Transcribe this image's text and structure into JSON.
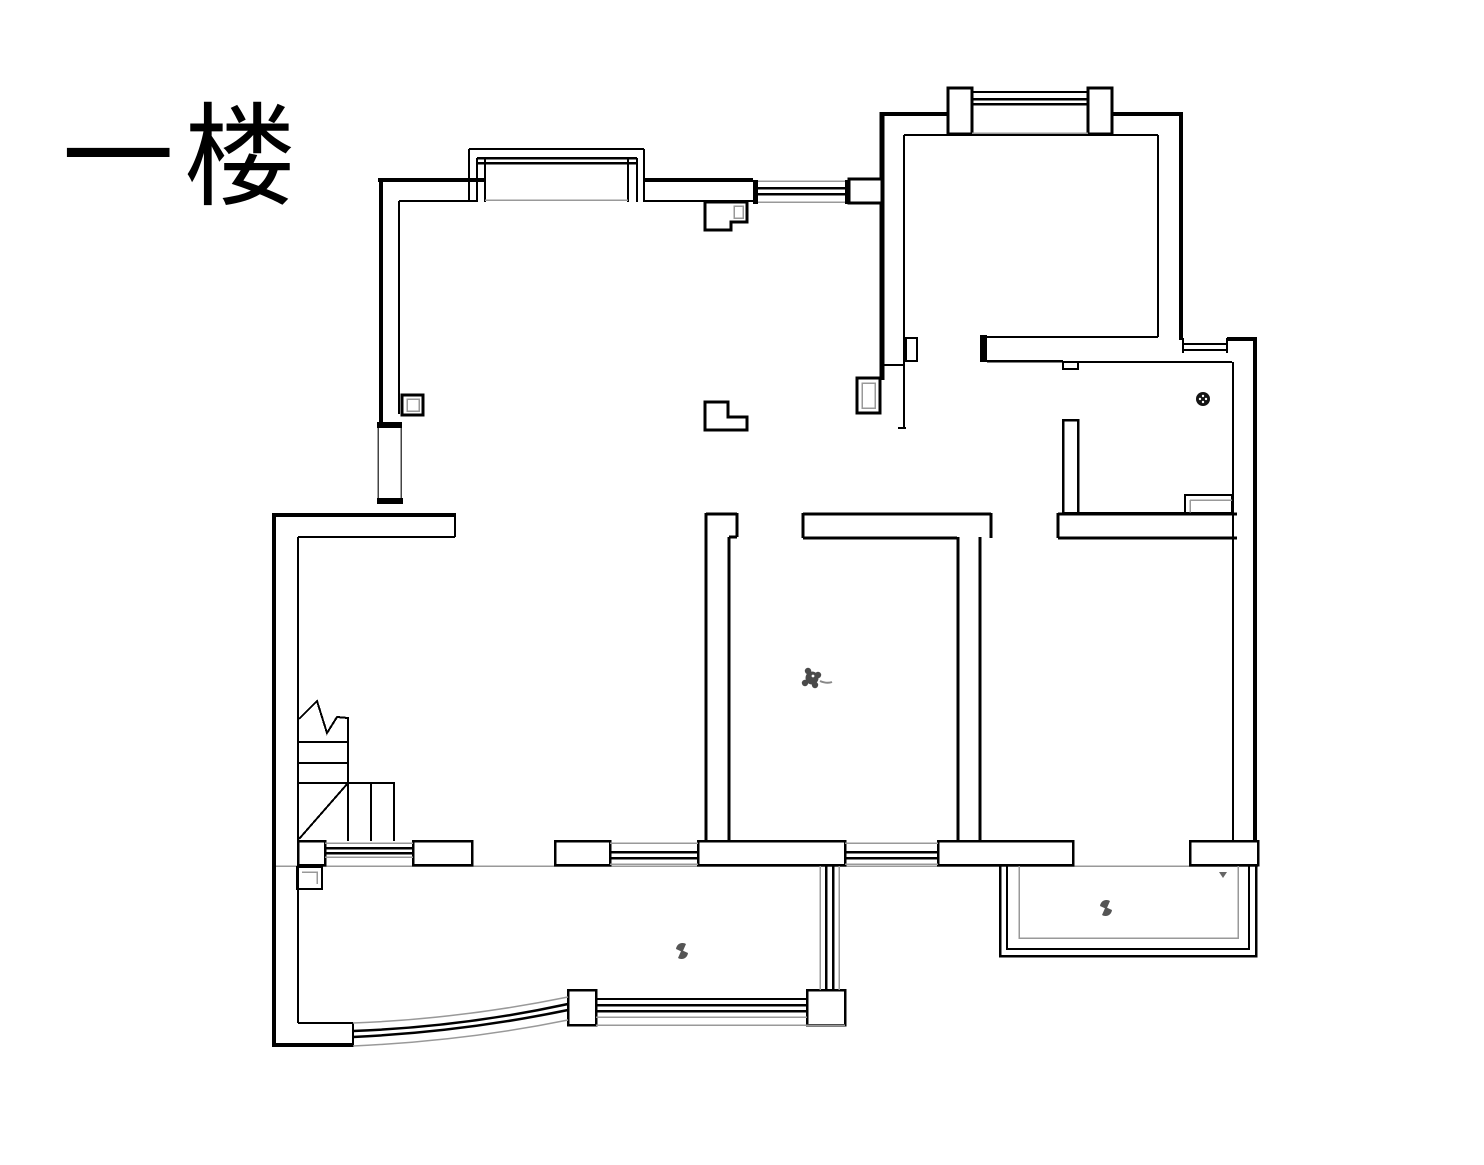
{
  "title": {
    "text": "一楼"
  },
  "floor_plan": {
    "label": "一楼",
    "colors": {
      "background": "#ffffff",
      "walls": "#000000",
      "thin_lines": "#888888",
      "sill_lines": "#999999",
      "symbols": "#4a4a4a"
    },
    "symbols": [
      {
        "name": "floor-drain-icon",
        "location": "small-room-right"
      },
      {
        "name": "plant-icon",
        "location": "middle-room"
      },
      {
        "name": "plant-icon",
        "location": "large-balcony"
      },
      {
        "name": "plant-icon",
        "location": "right-balcony"
      }
    ]
  }
}
